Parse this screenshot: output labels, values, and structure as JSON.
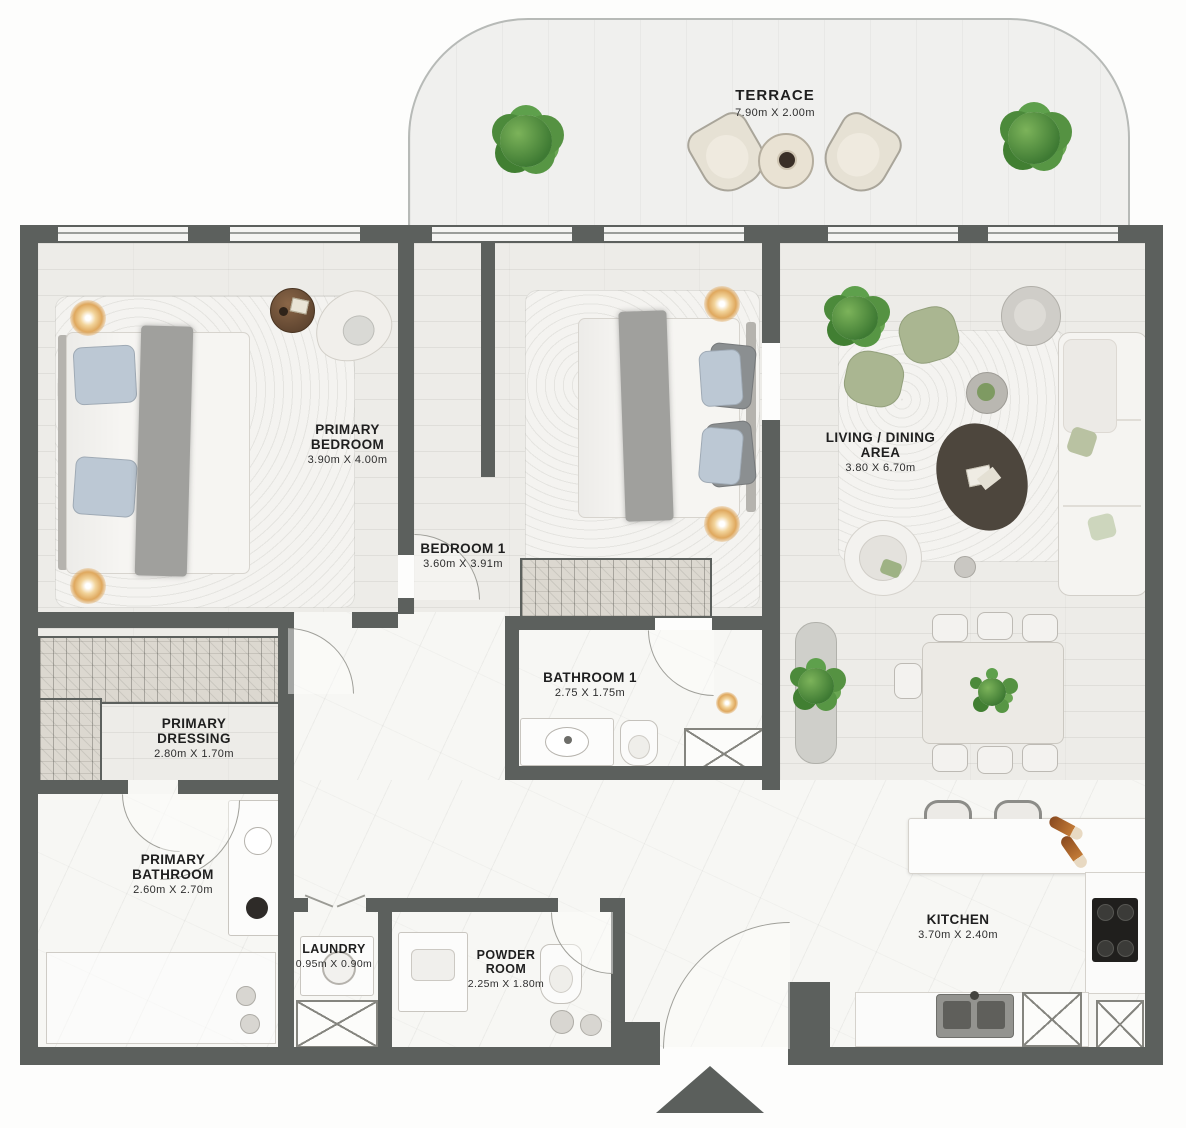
{
  "rooms": {
    "terrace": {
      "name": "TERRACE",
      "dims": "7.90m X 2.00m"
    },
    "primary_bedroom": {
      "name": "PRIMARY BEDROOM",
      "dims": "3.90m X 4.00m"
    },
    "bedroom_1": {
      "name": "BEDROOM 1",
      "dims": "3.60m X 3.91m"
    },
    "living_dining": {
      "name": "LIVING / DINING AREA",
      "dims": "3.80 X 6.70m"
    },
    "bathroom_1": {
      "name": "BATHROOM 1",
      "dims": "2.75 X 1.75m"
    },
    "primary_dressing": {
      "name": "PRIMARY DRESSING",
      "dims": "2.80m X 1.70m"
    },
    "primary_bathroom": {
      "name": "PRIMARY BATHROOM",
      "dims": "2.60m X 2.70m"
    },
    "laundry": {
      "name": "LAUNDRY",
      "dims": "0.95m X 0.90m"
    },
    "powder_room": {
      "name": "POWDER ROOM",
      "dims": "2.25m X 1.80m"
    },
    "kitchen": {
      "name": "KITCHEN",
      "dims": "3.70m X 2.40m"
    }
  },
  "colors": {
    "wall": "#5c605d",
    "plant_green": "#4e8f3d",
    "lamp_amber": "#e2b26a",
    "sage_furniture": "#aab691",
    "wood_floor": "#edece8",
    "marble_floor": "#f7f7f4"
  }
}
